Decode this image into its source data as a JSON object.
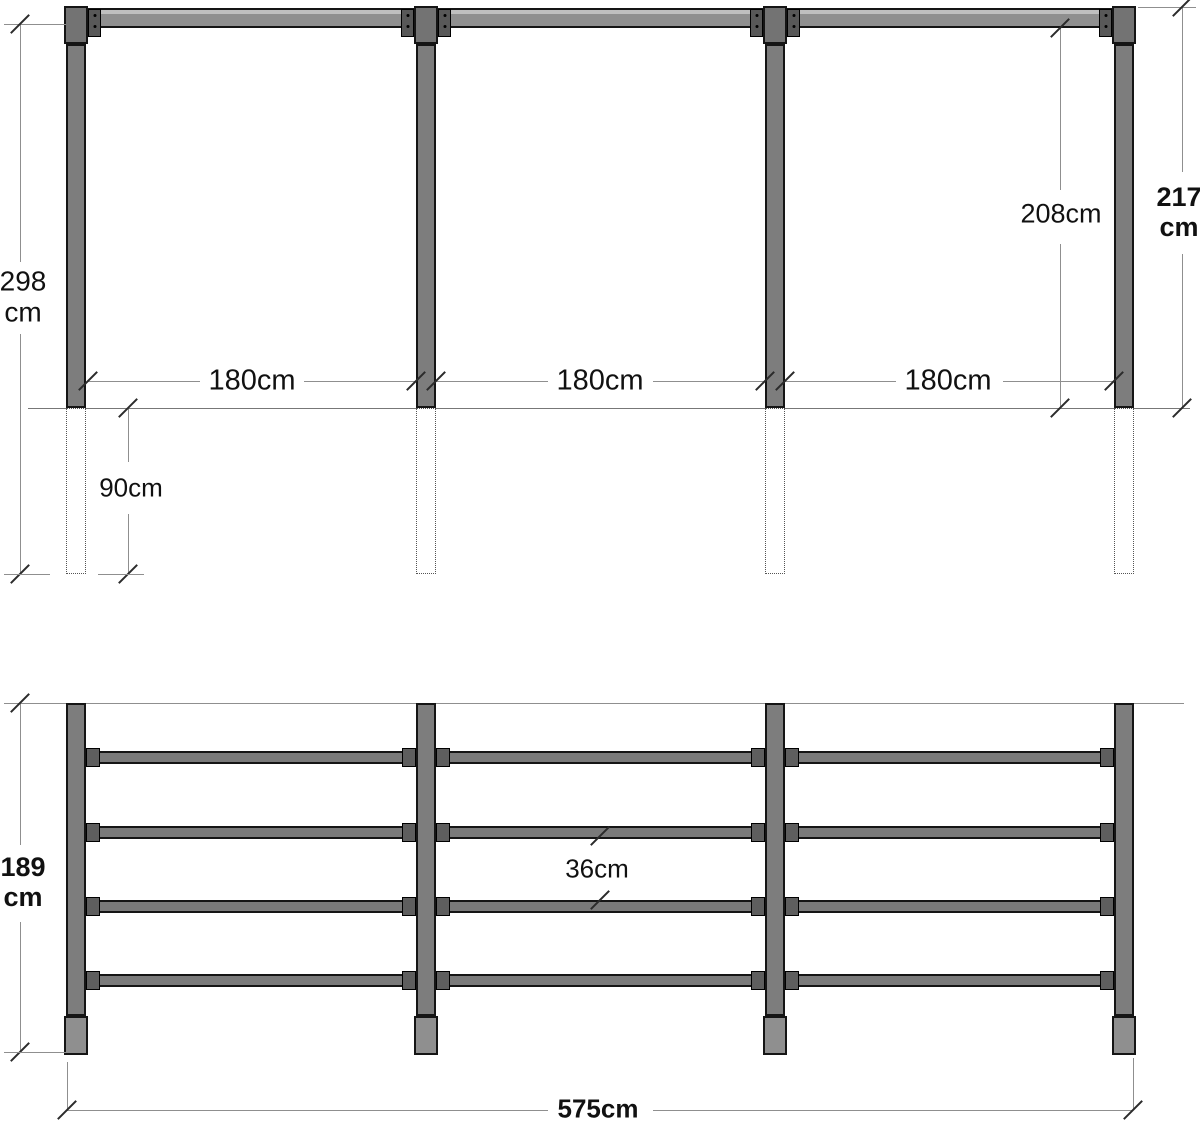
{
  "front_view": {
    "post_total_length": {
      "value": "298",
      "unit": "cm"
    },
    "bay_width_1": "180cm",
    "bay_width_2": "180cm",
    "bay_width_3": "180cm",
    "clear_height": "208cm",
    "total_height": {
      "value": "217",
      "unit": "cm"
    },
    "post_buried_depth": "90cm"
  },
  "rail_view": {
    "post_height": {
      "value": "189",
      "unit": "cm"
    },
    "rail_spacing": "36cm",
    "total_width": "575cm"
  },
  "structure": {
    "posts": 4,
    "bays": 3,
    "rails_per_bay": 4
  },
  "colors": {
    "post_fill": "#7d7d7d",
    "beam_fill": "#8f8f8f",
    "cap_fill": "#737373",
    "bracket_fill": "#585858",
    "rail_fill": "#7a7a7a",
    "connector_fill": "#5e5e5e",
    "base_fill": "#8f8f8f",
    "outline": "#151515",
    "dimension_line": "#8f8f8f",
    "text": "#111111"
  }
}
